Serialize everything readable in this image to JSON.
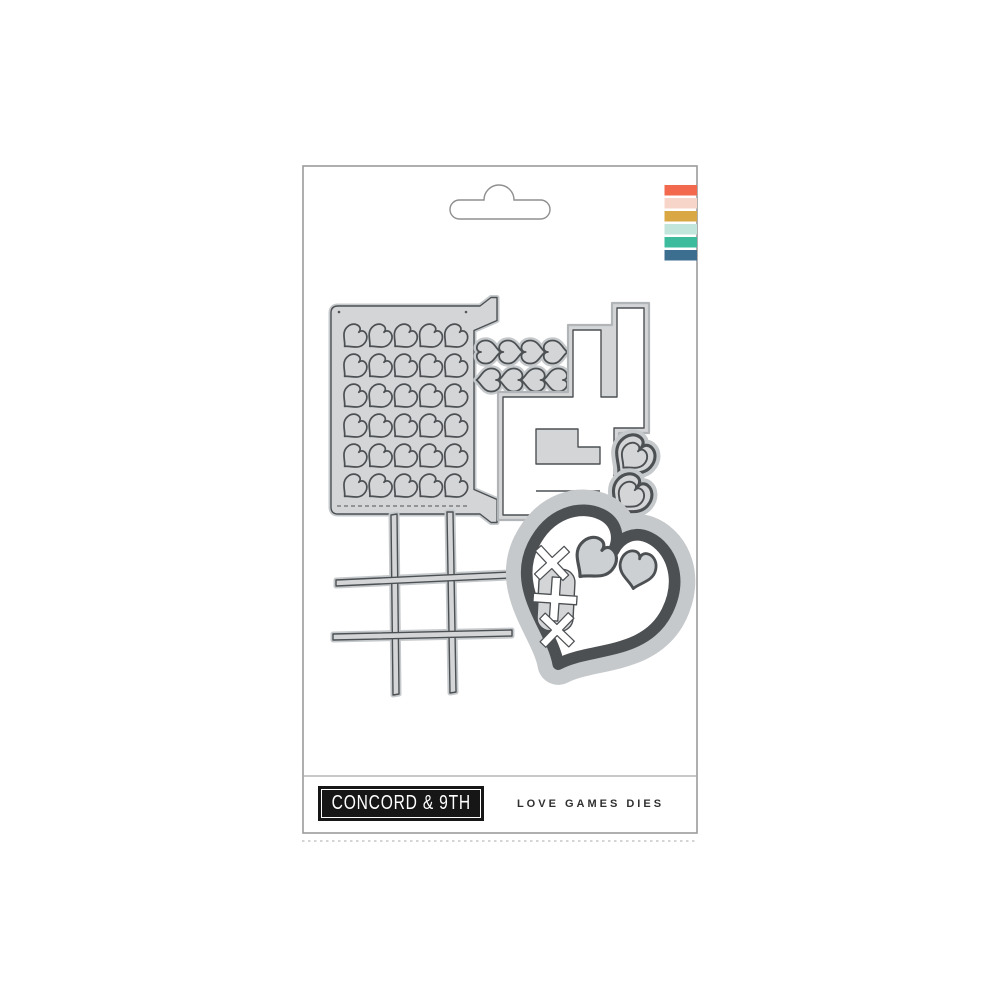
{
  "package": {
    "brand_label": "CONCORD & 9TH",
    "product_title": "LOVE GAMES DIES",
    "stripe_colors": [
      "#F2694E",
      "#F8D5C9",
      "#D9A845",
      "#C3E6DC",
      "#3CBC9D",
      "#3C6E8F"
    ],
    "colors": {
      "die_fill": "#d3d5d7",
      "die_outline": "#4d5053",
      "die_halo": "#c6c9cb",
      "package_border": "#9b9b9b",
      "logo_bg": "#161616",
      "logo_text": "#ffffff",
      "title_text": "#303030"
    },
    "dies": [
      {
        "name": "heart-grid-cover-plate-die"
      },
      {
        "name": "heart-border-chain-top-die"
      },
      {
        "name": "heart-border-chain-bottom-die"
      },
      {
        "name": "game-blocks-die"
      },
      {
        "name": "nested-heart-small-top-die"
      },
      {
        "name": "nested-heart-small-bottom-die"
      },
      {
        "name": "tic-tac-toe-grid-die"
      },
      {
        "name": "stitched-heart-xox-die"
      }
    ]
  }
}
